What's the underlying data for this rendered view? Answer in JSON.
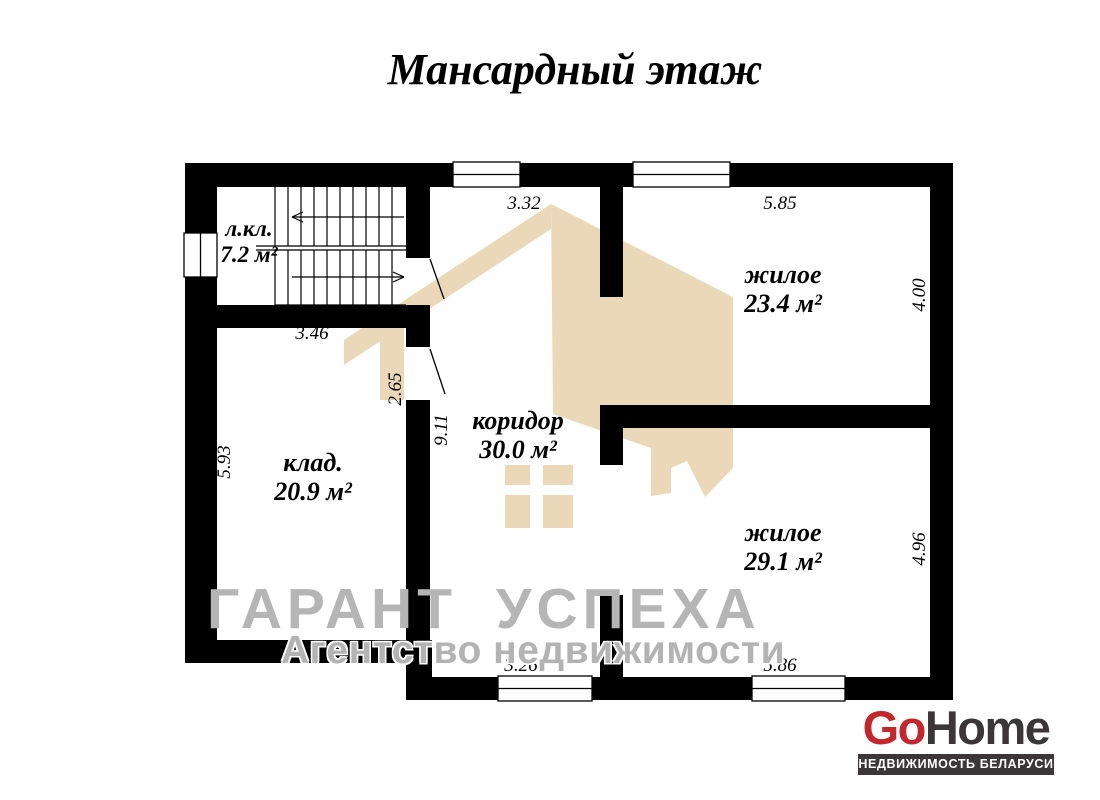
{
  "title": "Мансардный этаж",
  "rooms": {
    "stairwell": {
      "name": "л.кл.",
      "area": "7.2 м²"
    },
    "storage": {
      "name": "клад.",
      "area": "20.9 м²"
    },
    "corridor": {
      "name": "коридор",
      "area": "30.0 м²"
    },
    "living_top": {
      "name": "жилое",
      "area": "23.4 м²"
    },
    "living_bottom": {
      "name": "жилое",
      "area": "29.1 м²"
    }
  },
  "dims": {
    "corridor_top_width": "3.32",
    "living_top_width": "5.85",
    "living_top_height": "4.00",
    "stairwell_width": "3.46",
    "storage_height": "5.93",
    "entry_wall": "2.65",
    "corridor_height": "9.11",
    "living_bottom_height": "4.96",
    "corridor_bottom_width": "3.26",
    "living_bottom_width": "5.86"
  },
  "watermark": {
    "line1": "ГАРАНТ УСПЕХА",
    "line2": "Агентство недвижимости"
  },
  "logo": {
    "go": "Go",
    "home": "Home",
    "tagline": "НЕДВИЖИМОСТЬ БЕЛАРУСИ"
  },
  "colors": {
    "wall": "#000000",
    "watermark_house": "#ead8b8",
    "watermark_text": "#b5b5b5",
    "logo_red": "#c1272d",
    "logo_dark": "#3b3738"
  }
}
